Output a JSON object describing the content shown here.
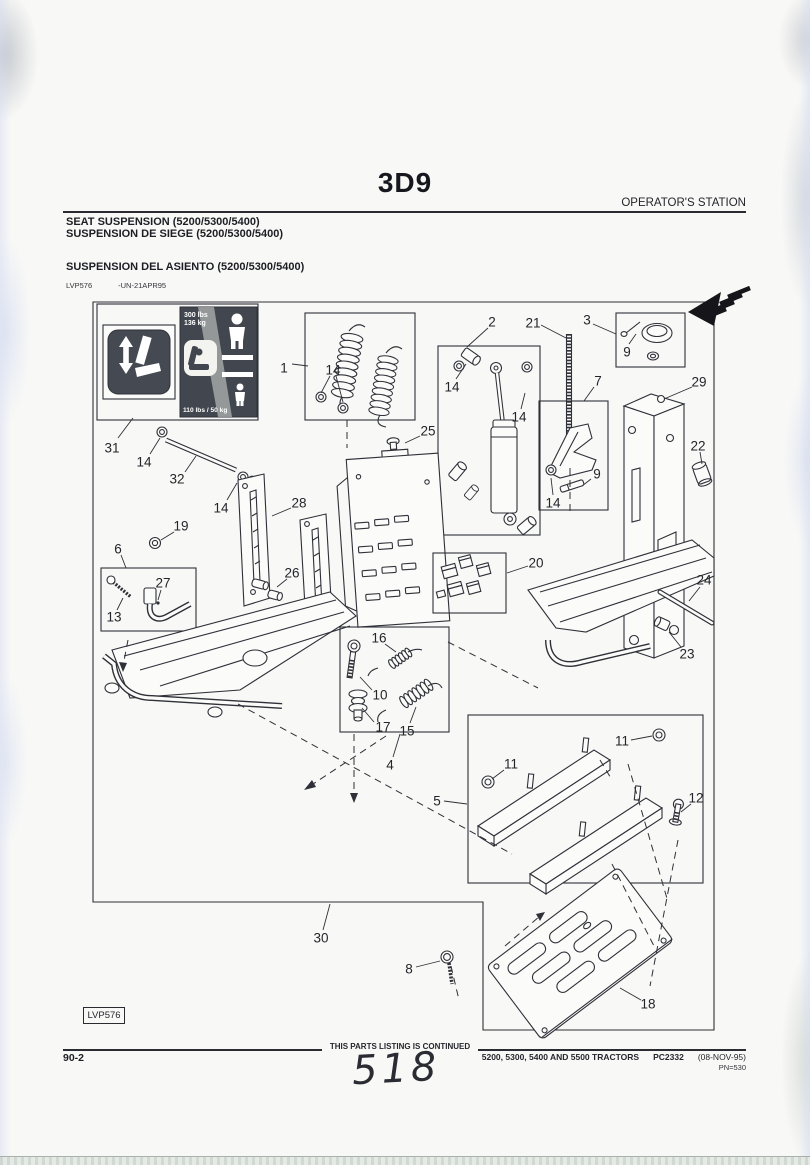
{
  "header": {
    "section_code": "3D9",
    "right_label": "OPERATOR'S STATION",
    "title_en": "SEAT SUSPENSION (5200/5300/5400)",
    "title_fr": "SUSPENSION DE SIEGE (5200/5300/5400)",
    "title_es": "SUSPENSION DEL ASIENTO (5200/5300/5400)",
    "figure_id": "LVP576",
    "figure_note": "-UN-21APR95"
  },
  "sticker": {
    "max_weight_line1": "300 lbs",
    "max_weight_line2": "136 kg",
    "min_weight": "110 lbs / 50 kg"
  },
  "figure_label": "LVP576",
  "footer": {
    "page_number": "90-2",
    "continued_note": "THIS PARTS LISTING IS CONTINUED",
    "models_line": "5200, 5300, 5400 AND 5500 TRACTORS",
    "catalog_code": "PC2332",
    "revision_date": "(08-NOV-95)",
    "print_number": "PN=530",
    "handwritten_mark": "518"
  },
  "colors": {
    "paper": "#f8f8f6",
    "ink": "#2f3038",
    "label_dark": "#43474f"
  },
  "diagram": {
    "callouts": [
      {
        "n": "31",
        "x": 112,
        "y": 448,
        "l": [
          [
            118,
            438,
            133,
            418
          ]
        ]
      },
      {
        "n": "1",
        "x": 284,
        "y": 368,
        "l": [
          [
            292,
            364,
            308,
            366
          ]
        ]
      },
      {
        "n": "14",
        "x": 333,
        "y": 370,
        "l": [
          [
            330,
            376,
            321,
            393
          ],
          [
            336,
            376,
            343,
            402
          ]
        ]
      },
      {
        "n": "2",
        "x": 492,
        "y": 322,
        "l": [
          [
            488,
            328,
            467,
            347
          ]
        ]
      },
      {
        "n": "21",
        "x": 533,
        "y": 323,
        "l": [
          [
            541,
            325,
            566,
            338
          ]
        ]
      },
      {
        "n": "3",
        "x": 587,
        "y": 320,
        "l": [
          [
            593,
            324,
            616,
            334
          ]
        ]
      },
      {
        "n": "9",
        "x": 627,
        "y": 352,
        "l": [
          [
            629,
            344,
            636,
            334
          ]
        ]
      },
      {
        "n": "29",
        "x": 699,
        "y": 382,
        "l": [
          [
            692,
            387,
            664,
            399
          ]
        ]
      },
      {
        "n": "14",
        "x": 452,
        "y": 387,
        "l": [
          [
            456,
            379,
            466,
            364
          ]
        ]
      },
      {
        "n": "14",
        "x": 519,
        "y": 417,
        "l": [
          [
            521,
            409,
            525,
            393
          ]
        ]
      },
      {
        "n": "7",
        "x": 598,
        "y": 381,
        "l": [
          [
            594,
            387,
            584,
            401
          ]
        ]
      },
      {
        "n": "22",
        "x": 698,
        "y": 446,
        "l": [
          [
            700,
            452,
            702,
            464
          ]
        ]
      },
      {
        "n": "25",
        "x": 428,
        "y": 431,
        "l": [
          [
            420,
            436,
            405,
            443
          ]
        ]
      },
      {
        "n": "9",
        "x": 597,
        "y": 474,
        "l": [
          [
            591,
            479,
            582,
            486
          ]
        ]
      },
      {
        "n": "14",
        "x": 553,
        "y": 503,
        "l": [
          [
            553,
            495,
            551,
            478
          ]
        ]
      },
      {
        "n": "14",
        "x": 144,
        "y": 462,
        "l": [
          [
            150,
            454,
            160,
            438
          ]
        ]
      },
      {
        "n": "32",
        "x": 177,
        "y": 479,
        "l": [
          [
            185,
            472,
            196,
            456
          ]
        ]
      },
      {
        "n": "14",
        "x": 221,
        "y": 508,
        "l": [
          [
            227,
            500,
            237,
            483
          ]
        ]
      },
      {
        "n": "28",
        "x": 299,
        "y": 503,
        "l": [
          [
            291,
            508,
            272,
            516
          ]
        ]
      },
      {
        "n": "19",
        "x": 181,
        "y": 526,
        "l": [
          [
            174,
            532,
            161,
            540
          ]
        ]
      },
      {
        "n": "6",
        "x": 118,
        "y": 549,
        "l": [
          [
            121,
            555,
            126,
            568
          ]
        ]
      },
      {
        "n": "27",
        "x": 163,
        "y": 583,
        "l": [
          [
            161,
            590,
            158,
            600
          ]
        ]
      },
      {
        "n": "13",
        "x": 114,
        "y": 617,
        "l": [
          [
            117,
            610,
            123,
            598
          ]
        ]
      },
      {
        "n": "26",
        "x": 292,
        "y": 573,
        "l": [
          [
            287,
            579,
            277,
            587
          ]
        ]
      },
      {
        "n": "20",
        "x": 536,
        "y": 563,
        "l": [
          [
            528,
            566,
            507,
            573
          ]
        ]
      },
      {
        "n": "24",
        "x": 704,
        "y": 580,
        "l": [
          [
            700,
            587,
            689,
            601
          ]
        ]
      },
      {
        "n": "23",
        "x": 687,
        "y": 654,
        "l": [
          [
            681,
            647,
            669,
            632
          ]
        ]
      },
      {
        "n": "16",
        "x": 379,
        "y": 638,
        "l": [
          [
            385,
            644,
            396,
            652
          ]
        ]
      },
      {
        "n": "10",
        "x": 380,
        "y": 695,
        "l": [
          [
            372,
            690,
            360,
            677
          ]
        ]
      },
      {
        "n": "17",
        "x": 383,
        "y": 727,
        "l": [
          [
            374,
            722,
            362,
            708
          ]
        ]
      },
      {
        "n": "15",
        "x": 407,
        "y": 731,
        "l": [
          [
            410,
            723,
            416,
            707
          ]
        ]
      },
      {
        "n": "4",
        "x": 390,
        "y": 765,
        "l": [
          [
            393,
            757,
            400,
            734
          ]
        ]
      },
      {
        "n": "11",
        "x": 511,
        "y": 764,
        "l": [
          [
            504,
            770,
            492,
            779
          ]
        ]
      },
      {
        "n": "11",
        "x": 622,
        "y": 741,
        "l": [
          [
            631,
            740,
            652,
            736
          ]
        ]
      },
      {
        "n": "5",
        "x": 437,
        "y": 801,
        "l": [
          [
            444,
            801,
            467,
            804
          ]
        ]
      },
      {
        "n": "12",
        "x": 696,
        "y": 798,
        "l": [
          [
            691,
            804,
            681,
            812
          ]
        ]
      },
      {
        "n": "30",
        "x": 321,
        "y": 938,
        "l": [
          [
            323,
            930,
            330,
            904
          ]
        ]
      },
      {
        "n": "8",
        "x": 409,
        "y": 969,
        "l": [
          [
            416,
            967,
            440,
            961
          ]
        ]
      },
      {
        "n": "18",
        "x": 648,
        "y": 1004,
        "l": [
          [
            641,
            1000,
            620,
            988
          ]
        ]
      }
    ]
  }
}
